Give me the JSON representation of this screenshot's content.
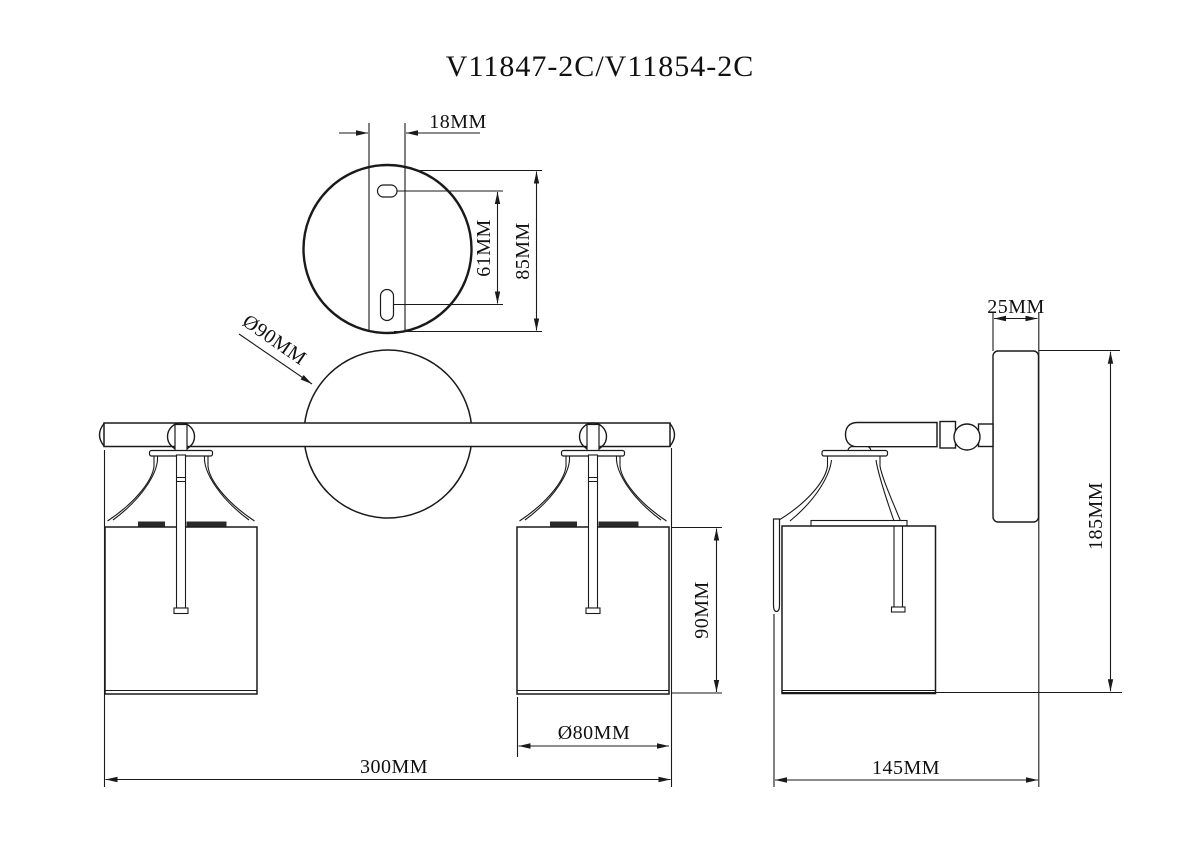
{
  "title": "V11847-2C/V11854-2C",
  "views": {
    "mounting_plate_top": {
      "dims": {
        "keyhole_offset": "18MM",
        "slot_spacing": "61MM",
        "plate_height": "85MM"
      }
    },
    "front": {
      "dims": {
        "backplate_diameter": "Ø90MM",
        "shade_height": "90MM",
        "shade_diameter": "Ø80MM",
        "overall_width": "300MM"
      }
    },
    "side": {
      "dims": {
        "backplate_depth": "25MM",
        "overall_height": "185MM",
        "overall_depth": "145MM"
      }
    }
  },
  "colors": {
    "line": "#1a1a1a",
    "background": "#ffffff"
  }
}
